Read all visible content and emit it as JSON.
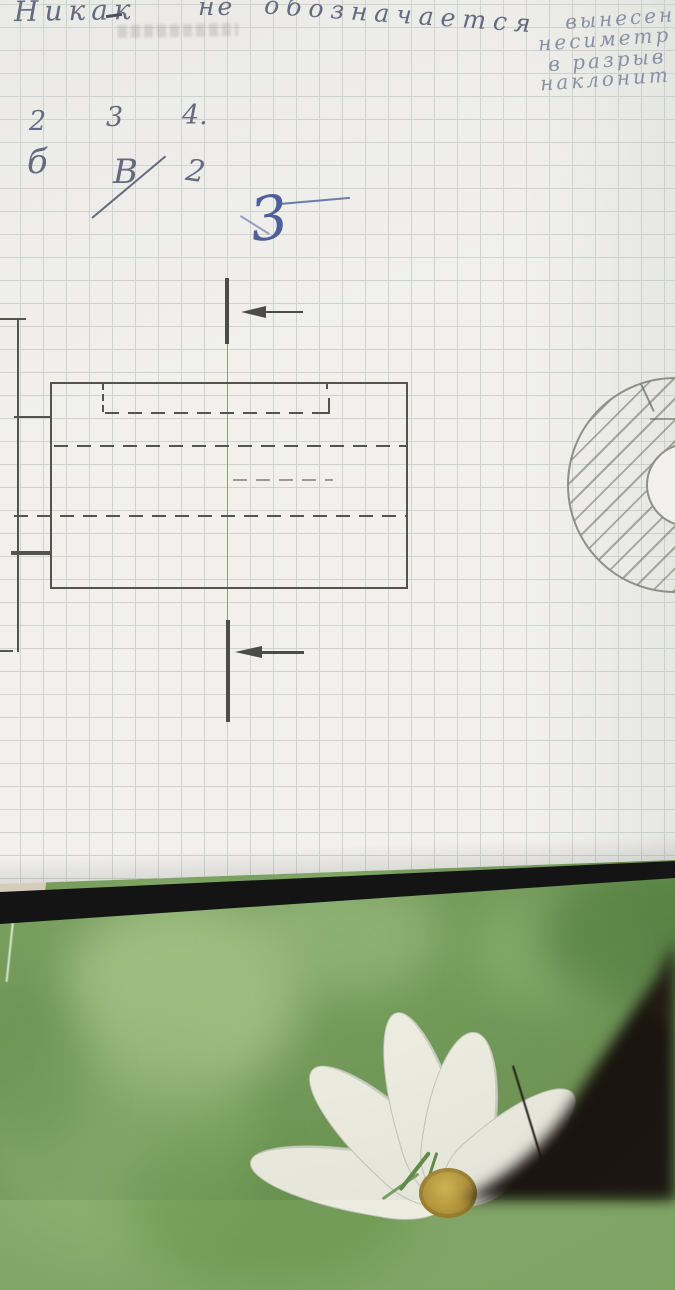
{
  "handwriting": {
    "main_note_word1": "Никак",
    "main_note_word2": "не",
    "main_note_word3": "обозначается",
    "side_note_lines": [
      "вынесен",
      "несиметр",
      "в разрыв",
      "наклонит"
    ],
    "answers_row1": [
      "2",
      "3",
      "4."
    ],
    "answers_row2_a": "б",
    "answers_row2_b": "В",
    "answers_row2_c": "2",
    "section_label": "3"
  },
  "colors": {
    "pencil": "#54544f",
    "pencil_light": "#8f8f89",
    "ink": "#646a80",
    "ink_light": "#8a90a4",
    "pen": "#4f5f9b",
    "paper": "#f1f0ec",
    "grid": "#cdd3ce",
    "green": "#7ca262",
    "black_edge": "#141414",
    "beige": "#d5ccbb",
    "petal": "#ebebdf",
    "flower_center": "#c2a23c"
  }
}
